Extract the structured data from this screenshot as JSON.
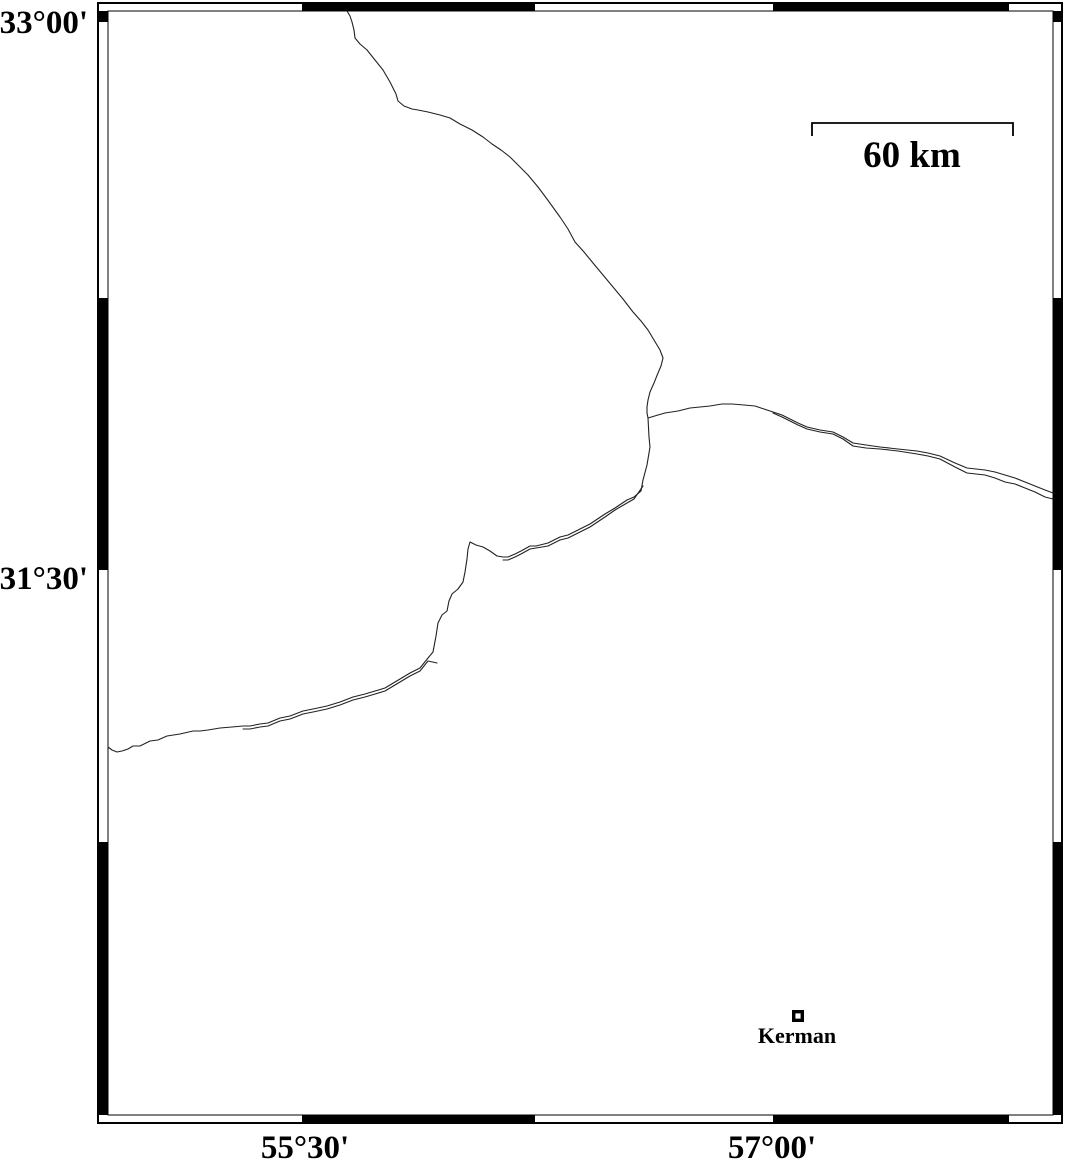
{
  "figure": {
    "width": 1066,
    "height": 1163,
    "background": "#ffffff",
    "ink": "#000000"
  },
  "frame": {
    "outer": {
      "x": 98,
      "y": 3,
      "w": 964,
      "h": 1120,
      "stroke_w": 1.6
    },
    "inner": {
      "x": 108,
      "y": 11,
      "w": 945,
      "h": 1104,
      "stroke_w": 1.1
    },
    "horizontal_black_segments": [
      [
        302,
        535
      ],
      [
        773,
        1009
      ]
    ],
    "vertical_black_segments": [
      [
        11,
        22
      ],
      [
        298,
        570
      ],
      [
        842,
        1115
      ]
    ]
  },
  "axis": {
    "font_size": 33,
    "left_labels": [
      {
        "text": "33°00'",
        "x": 88,
        "baseline": 33
      },
      {
        "text": "31°30'",
        "x": 88,
        "baseline": 589
      }
    ],
    "bottom_labels": [
      {
        "text": "55°30'",
        "x": 305,
        "baseline": 1158
      },
      {
        "text": "57°00'",
        "x": 772,
        "baseline": 1158
      }
    ]
  },
  "scale_bar": {
    "label": "60 km",
    "distance_km": 60,
    "font_size": 37,
    "x1": 812,
    "x2": 1013,
    "bar_y": 123,
    "tick_drop": 13,
    "label_x": 912,
    "label_baseline": 167,
    "stroke_w": 1.8
  },
  "city": {
    "name": "Kerman",
    "font_size": 22,
    "marker": {
      "x": 792,
      "y": 1010,
      "size": 12,
      "border": 3.4
    },
    "label_x": 797,
    "label_baseline": 1043
  },
  "map_lines": {
    "stroke": "#222222",
    "width": 1.1,
    "paths": [
      {
        "name": "boundary-line-north",
        "points": [
          [
            347,
            11
          ],
          [
            350,
            16
          ],
          [
            352,
            22
          ],
          [
            354,
            30
          ],
          [
            355,
            38
          ],
          [
            360,
            44
          ],
          [
            367,
            50
          ],
          [
            375,
            60
          ],
          [
            383,
            70
          ],
          [
            390,
            82
          ],
          [
            396,
            94
          ],
          [
            398,
            101
          ],
          [
            404,
            106
          ],
          [
            412,
            109
          ],
          [
            418,
            110
          ],
          [
            428,
            112
          ],
          [
            440,
            115
          ],
          [
            450,
            118
          ],
          [
            460,
            124
          ],
          [
            472,
            130
          ],
          [
            483,
            137
          ],
          [
            492,
            144
          ],
          [
            501,
            150
          ],
          [
            510,
            157
          ],
          [
            519,
            166
          ],
          [
            528,
            175
          ],
          [
            538,
            187
          ],
          [
            547,
            199
          ],
          [
            560,
            217
          ],
          [
            568,
            229
          ],
          [
            575,
            242
          ],
          [
            584,
            252
          ],
          [
            593,
            263
          ],
          [
            603,
            275
          ],
          [
            613,
            287
          ],
          [
            623,
            299
          ],
          [
            633,
            312
          ],
          [
            641,
            321
          ],
          [
            648,
            330
          ],
          [
            654,
            340
          ],
          [
            660,
            350
          ],
          [
            663,
            358
          ],
          [
            661,
            366
          ],
          [
            658,
            373
          ],
          [
            654,
            383
          ],
          [
            650,
            392
          ],
          [
            648,
            400
          ],
          [
            647,
            407
          ],
          [
            647,
            413
          ],
          [
            648,
            418
          ]
        ]
      },
      {
        "name": "boundary-line-southwest",
        "points": [
          [
            648,
            418
          ],
          [
            649,
            437
          ],
          [
            650,
            447
          ],
          [
            647,
            465
          ],
          [
            643,
            480
          ],
          [
            641,
            491
          ],
          [
            634,
            497
          ],
          [
            627,
            500
          ],
          [
            615,
            508
          ],
          [
            605,
            514
          ],
          [
            590,
            524
          ],
          [
            580,
            529
          ],
          [
            568,
            535
          ],
          [
            560,
            537
          ],
          [
            548,
            543
          ],
          [
            536,
            546
          ],
          [
            530,
            546
          ],
          [
            521,
            551
          ],
          [
            515,
            554
          ],
          [
            508,
            557
          ],
          [
            503,
            557
          ],
          [
            497,
            556
          ],
          [
            490,
            551
          ],
          [
            483,
            547
          ],
          [
            476,
            545
          ],
          [
            470,
            542
          ],
          [
            468,
            549
          ],
          [
            467,
            559
          ],
          [
            465,
            572
          ],
          [
            463,
            582
          ],
          [
            458,
            589
          ],
          [
            452,
            594
          ],
          [
            449,
            601
          ],
          [
            447,
            611
          ],
          [
            442,
            615
          ],
          [
            438,
            623
          ],
          [
            436,
            636
          ],
          [
            433,
            652
          ],
          [
            428,
            658
          ],
          [
            420,
            668
          ],
          [
            410,
            673
          ],
          [
            400,
            679
          ],
          [
            385,
            688
          ],
          [
            365,
            694
          ],
          [
            353,
            697
          ],
          [
            340,
            702
          ],
          [
            327,
            706
          ],
          [
            313,
            709
          ],
          [
            303,
            711
          ],
          [
            290,
            716
          ],
          [
            280,
            718
          ],
          [
            268,
            723
          ],
          [
            260,
            724
          ],
          [
            250,
            726
          ],
          [
            243,
            726
          ],
          [
            232,
            727
          ],
          [
            220,
            728
          ],
          [
            208,
            730
          ],
          [
            200,
            731
          ],
          [
            193,
            731
          ],
          [
            180,
            734
          ],
          [
            167,
            736
          ],
          [
            158,
            740
          ],
          [
            150,
            741
          ],
          [
            140,
            746
          ],
          [
            133,
            746
          ],
          [
            128,
            749
          ],
          [
            122,
            751
          ],
          [
            117,
            752
          ],
          [
            112,
            750
          ],
          [
            108,
            747
          ]
        ]
      },
      {
        "name": "boundary-line-southwest-strand",
        "points": [
          [
            643,
            486
          ],
          [
            634,
            499
          ],
          [
            627,
            503
          ],
          [
            615,
            510
          ],
          [
            605,
            517
          ],
          [
            590,
            527
          ],
          [
            580,
            532
          ],
          [
            568,
            538
          ],
          [
            560,
            540
          ],
          [
            548,
            546
          ],
          [
            536,
            548
          ],
          [
            530,
            549
          ],
          [
            521,
            554
          ],
          [
            515,
            557
          ],
          [
            508,
            560
          ],
          [
            503,
            560
          ]
        ]
      },
      {
        "name": "boundary-line-southwest-strand-2",
        "points": [
          [
            437,
            663
          ],
          [
            428,
            661
          ],
          [
            420,
            671
          ],
          [
            410,
            676
          ],
          [
            400,
            682
          ],
          [
            385,
            691
          ],
          [
            365,
            697
          ],
          [
            353,
            700
          ],
          [
            340,
            705
          ],
          [
            327,
            709
          ],
          [
            313,
            712
          ],
          [
            303,
            714
          ],
          [
            290,
            719
          ],
          [
            280,
            721
          ],
          [
            268,
            726
          ],
          [
            260,
            727
          ],
          [
            250,
            729
          ],
          [
            243,
            729
          ]
        ]
      },
      {
        "name": "boundary-line-east-upper",
        "points": [
          [
            648,
            418
          ],
          [
            658,
            415
          ],
          [
            665,
            413
          ],
          [
            678,
            411
          ],
          [
            690,
            408
          ],
          [
            700,
            407
          ],
          [
            710,
            406
          ],
          [
            722,
            404
          ],
          [
            732,
            404
          ],
          [
            744,
            405
          ],
          [
            755,
            406
          ],
          [
            764,
            409
          ],
          [
            773,
            412
          ],
          [
            782,
            415
          ],
          [
            790,
            419
          ],
          [
            798,
            423
          ],
          [
            807,
            427
          ],
          [
            820,
            430
          ],
          [
            833,
            432
          ],
          [
            843,
            437
          ],
          [
            853,
            443
          ],
          [
            866,
            445
          ],
          [
            880,
            447
          ],
          [
            898,
            449
          ],
          [
            917,
            451
          ],
          [
            928,
            453
          ],
          [
            940,
            456
          ],
          [
            955,
            463
          ],
          [
            967,
            468
          ],
          [
            976,
            469
          ],
          [
            985,
            470
          ],
          [
            995,
            472
          ],
          [
            1005,
            475
          ],
          [
            1015,
            478
          ],
          [
            1025,
            482
          ],
          [
            1035,
            486
          ],
          [
            1045,
            490
          ],
          [
            1053,
            493
          ]
        ]
      },
      {
        "name": "boundary-line-east-lower",
        "points": [
          [
            773,
            413
          ],
          [
            782,
            417
          ],
          [
            790,
            421
          ],
          [
            798,
            425
          ],
          [
            807,
            429
          ],
          [
            820,
            432
          ],
          [
            833,
            434
          ],
          [
            843,
            439
          ],
          [
            853,
            446
          ],
          [
            866,
            448
          ],
          [
            880,
            449
          ],
          [
            898,
            451
          ],
          [
            917,
            454
          ],
          [
            928,
            456
          ],
          [
            940,
            459
          ],
          [
            955,
            467
          ],
          [
            967,
            473
          ],
          [
            976,
            474
          ],
          [
            985,
            475
          ],
          [
            995,
            478
          ],
          [
            1005,
            482
          ],
          [
            1015,
            484
          ],
          [
            1025,
            488
          ],
          [
            1035,
            492
          ],
          [
            1045,
            497
          ],
          [
            1053,
            499
          ]
        ]
      }
    ]
  }
}
